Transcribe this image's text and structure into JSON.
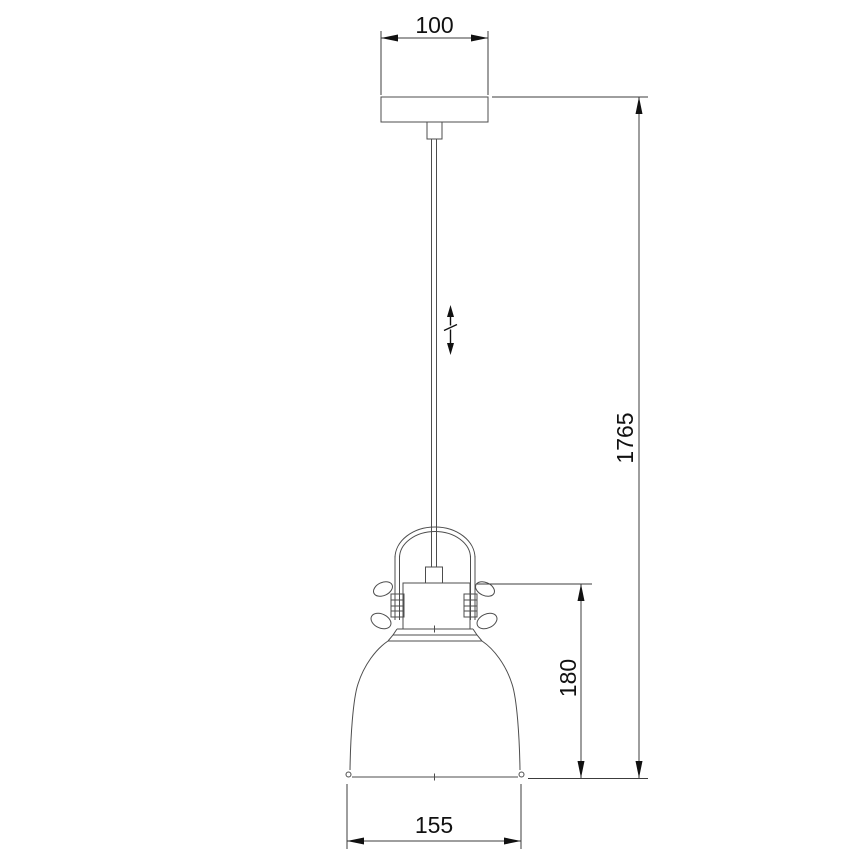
{
  "colors": {
    "background": "#ffffff",
    "drawing_line": "#4d4d4d",
    "dimension_line": "#3c3c3c",
    "text": "#111111"
  },
  "dimensions": {
    "canopy_width": "100",
    "total_height": "1765",
    "shade_height": "180",
    "shade_diameter": "155"
  },
  "icons": {
    "adjustable_height_symbol": "double-headed-vertical-arrow-with-slash"
  }
}
